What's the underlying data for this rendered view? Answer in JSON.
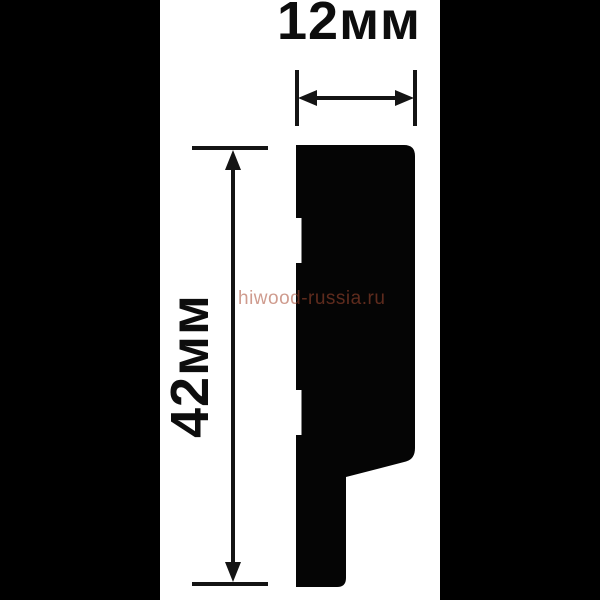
{
  "canvas": {
    "background_color": "#ffffff",
    "letterbox_color": "#000000"
  },
  "diagram": {
    "width_dimension": {
      "label": "12мм"
    },
    "height_dimension": {
      "label": "42мм"
    },
    "watermark": {
      "text": "hiwood-russia.ru",
      "color": "#a84b32"
    },
    "profile_color": "#050505",
    "dimension_line_color": "#141414",
    "label_color": "#0d0d0d"
  }
}
